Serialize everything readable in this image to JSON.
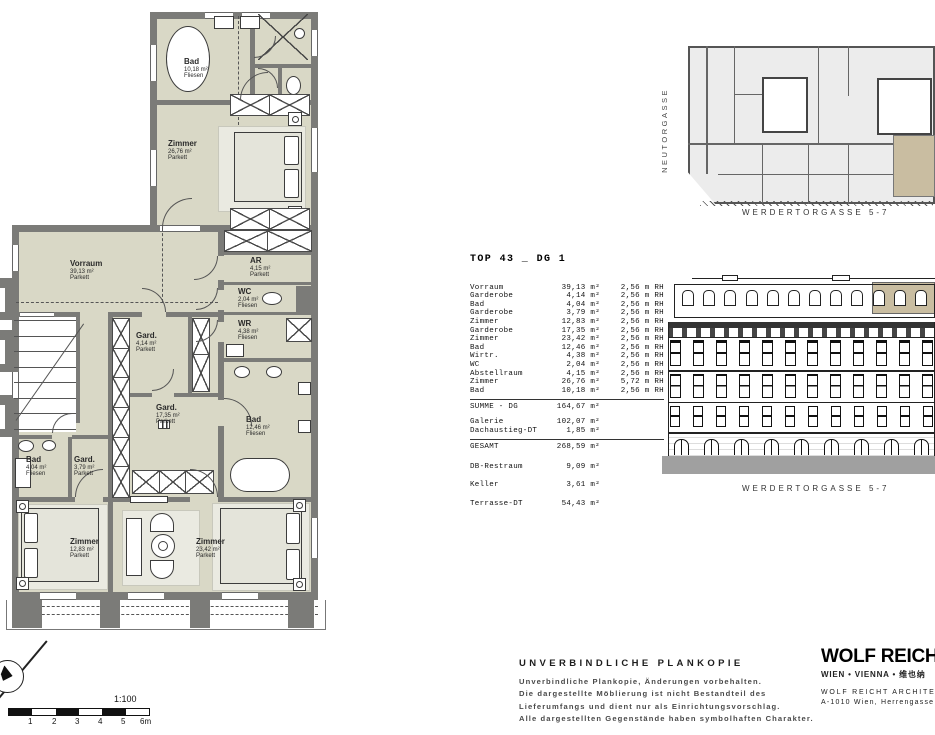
{
  "floor_plan": {
    "rooms": [
      {
        "id": "bad-top",
        "name": "Bad",
        "area": "10,18 m²",
        "floor": "Fliesen"
      },
      {
        "id": "zimmer-top",
        "name": "Zimmer",
        "area": "26,76 m²",
        "floor": "Parkett"
      },
      {
        "id": "vorraum",
        "name": "Vorraum",
        "area": "39,13 m²",
        "floor": "Parkett"
      },
      {
        "id": "abstellraum",
        "name": "AR",
        "area": "4,15 m²",
        "floor": "Parkett"
      },
      {
        "id": "wc",
        "name": "WC",
        "area": "2,04 m²",
        "floor": "Fliesen"
      },
      {
        "id": "wirtschaftsraum",
        "name": "WR",
        "area": "4,38 m²",
        "floor": "Fliesen"
      },
      {
        "id": "garderobe-klein",
        "name": "Gard.",
        "area": "4,14 m²",
        "floor": "Parkett"
      },
      {
        "id": "garderobe-gross",
        "name": "Gard.",
        "area": "17,35 m²",
        "floor": "Parkett"
      },
      {
        "id": "bad-mitte",
        "name": "Bad",
        "area": "12,46 m²",
        "floor": "Fliesen"
      },
      {
        "id": "bad-klein",
        "name": "Bad",
        "area": "4,04 m²",
        "floor": "Fliesen"
      },
      {
        "id": "garderobe-379",
        "name": "Gard.",
        "area": "3,79 m²",
        "floor": "Parkett"
      },
      {
        "id": "zimmer-sw",
        "name": "Zimmer",
        "area": "12,83 m²",
        "floor": "Parkett"
      },
      {
        "id": "zimmer-sued",
        "name": "Zimmer",
        "area": "23,42 m²",
        "floor": "Parkett"
      }
    ],
    "scale": {
      "ratio": "1:100",
      "ticks": [
        "1",
        "2",
        "3",
        "4",
        "5",
        "6m"
      ]
    }
  },
  "area_table": {
    "title": "TOP 43 _ DG 1",
    "rows": [
      {
        "name": "Vorraum",
        "area": "39,13 m²",
        "height": "2,56 m RH"
      },
      {
        "name": "Garderobe",
        "area": "4,14 m²",
        "height": "2,56 m RH"
      },
      {
        "name": "Bad",
        "area": "4,04 m²",
        "height": "2,56 m RH"
      },
      {
        "name": "Garderobe",
        "area": "3,79 m²",
        "height": "2,56 m RH"
      },
      {
        "name": "Zimmer",
        "area": "12,83 m²",
        "height": "2,56 m RH"
      },
      {
        "name": "Garderobe",
        "area": "17,35 m²",
        "height": "2,56 m RH"
      },
      {
        "name": "Zimmer",
        "area": "23,42 m²",
        "height": "2,56 m RH"
      },
      {
        "name": "Bad",
        "area": "12,46 m²",
        "height": "2,56 m RH"
      },
      {
        "name": "Wirtr.",
        "area": "4,38 m²",
        "height": "2,56 m RH"
      },
      {
        "name": "WC",
        "area": "2,04 m²",
        "height": "2,56 m RH"
      },
      {
        "name": "Abstellraum",
        "area": "4,15 m²",
        "height": "2,56 m RH"
      },
      {
        "name": "Zimmer",
        "area": "26,76 m²",
        "height": "5,72 m RH"
      },
      {
        "name": "Bad",
        "area": "10,18 m²",
        "height": "2,56 m RH"
      }
    ],
    "summary": [
      {
        "label": "SUMME - DG",
        "value": "164,67 m²"
      },
      {
        "label": "Galerie",
        "value": "102,07 m²"
      },
      {
        "label": "Dachaustieg-DT",
        "value": "1,85 m²"
      },
      {
        "label": "GESAMT",
        "value": "268,59 m²"
      },
      {
        "label": "DB-Restraum",
        "value": "9,09 m²"
      },
      {
        "label": "Keller",
        "value": "3,61 m²"
      },
      {
        "label": "Terrasse-DT",
        "value": "54,43 m²"
      }
    ]
  },
  "site_plan": {
    "street_left": "NEUTORGASSE",
    "caption": "WERDERTORGASSE 5-7"
  },
  "elevation": {
    "caption": "WERDERTORGASSE 5-7"
  },
  "disclaimer": {
    "title": "UNVERBINDLICHE PLANKOPIE",
    "lines": [
      "Unverbindliche Plankopie, Änderungen vorbehalten.",
      "Die dargestellte Möblierung ist nicht Bestandteil des",
      "Lieferumfangs und dient nur als Einrichtungsvorschlag.",
      "Alle dargestellten Gegenstände haben symbolhaften Charakter."
    ]
  },
  "firm": {
    "name_bold": "WOLF REICHT",
    "name_light": "ARCHITECTS",
    "subtitle": "WIEN • VIENNA • 维也纳",
    "line1": "WOLF REICHT ARCHITECTS",
    "line2": "A-1010 Wien, Herrengasse 6"
  },
  "colors": {
    "room_fill": "#d9d8c6",
    "wall": "#7b7b78",
    "highlight": "#c9bda1"
  }
}
